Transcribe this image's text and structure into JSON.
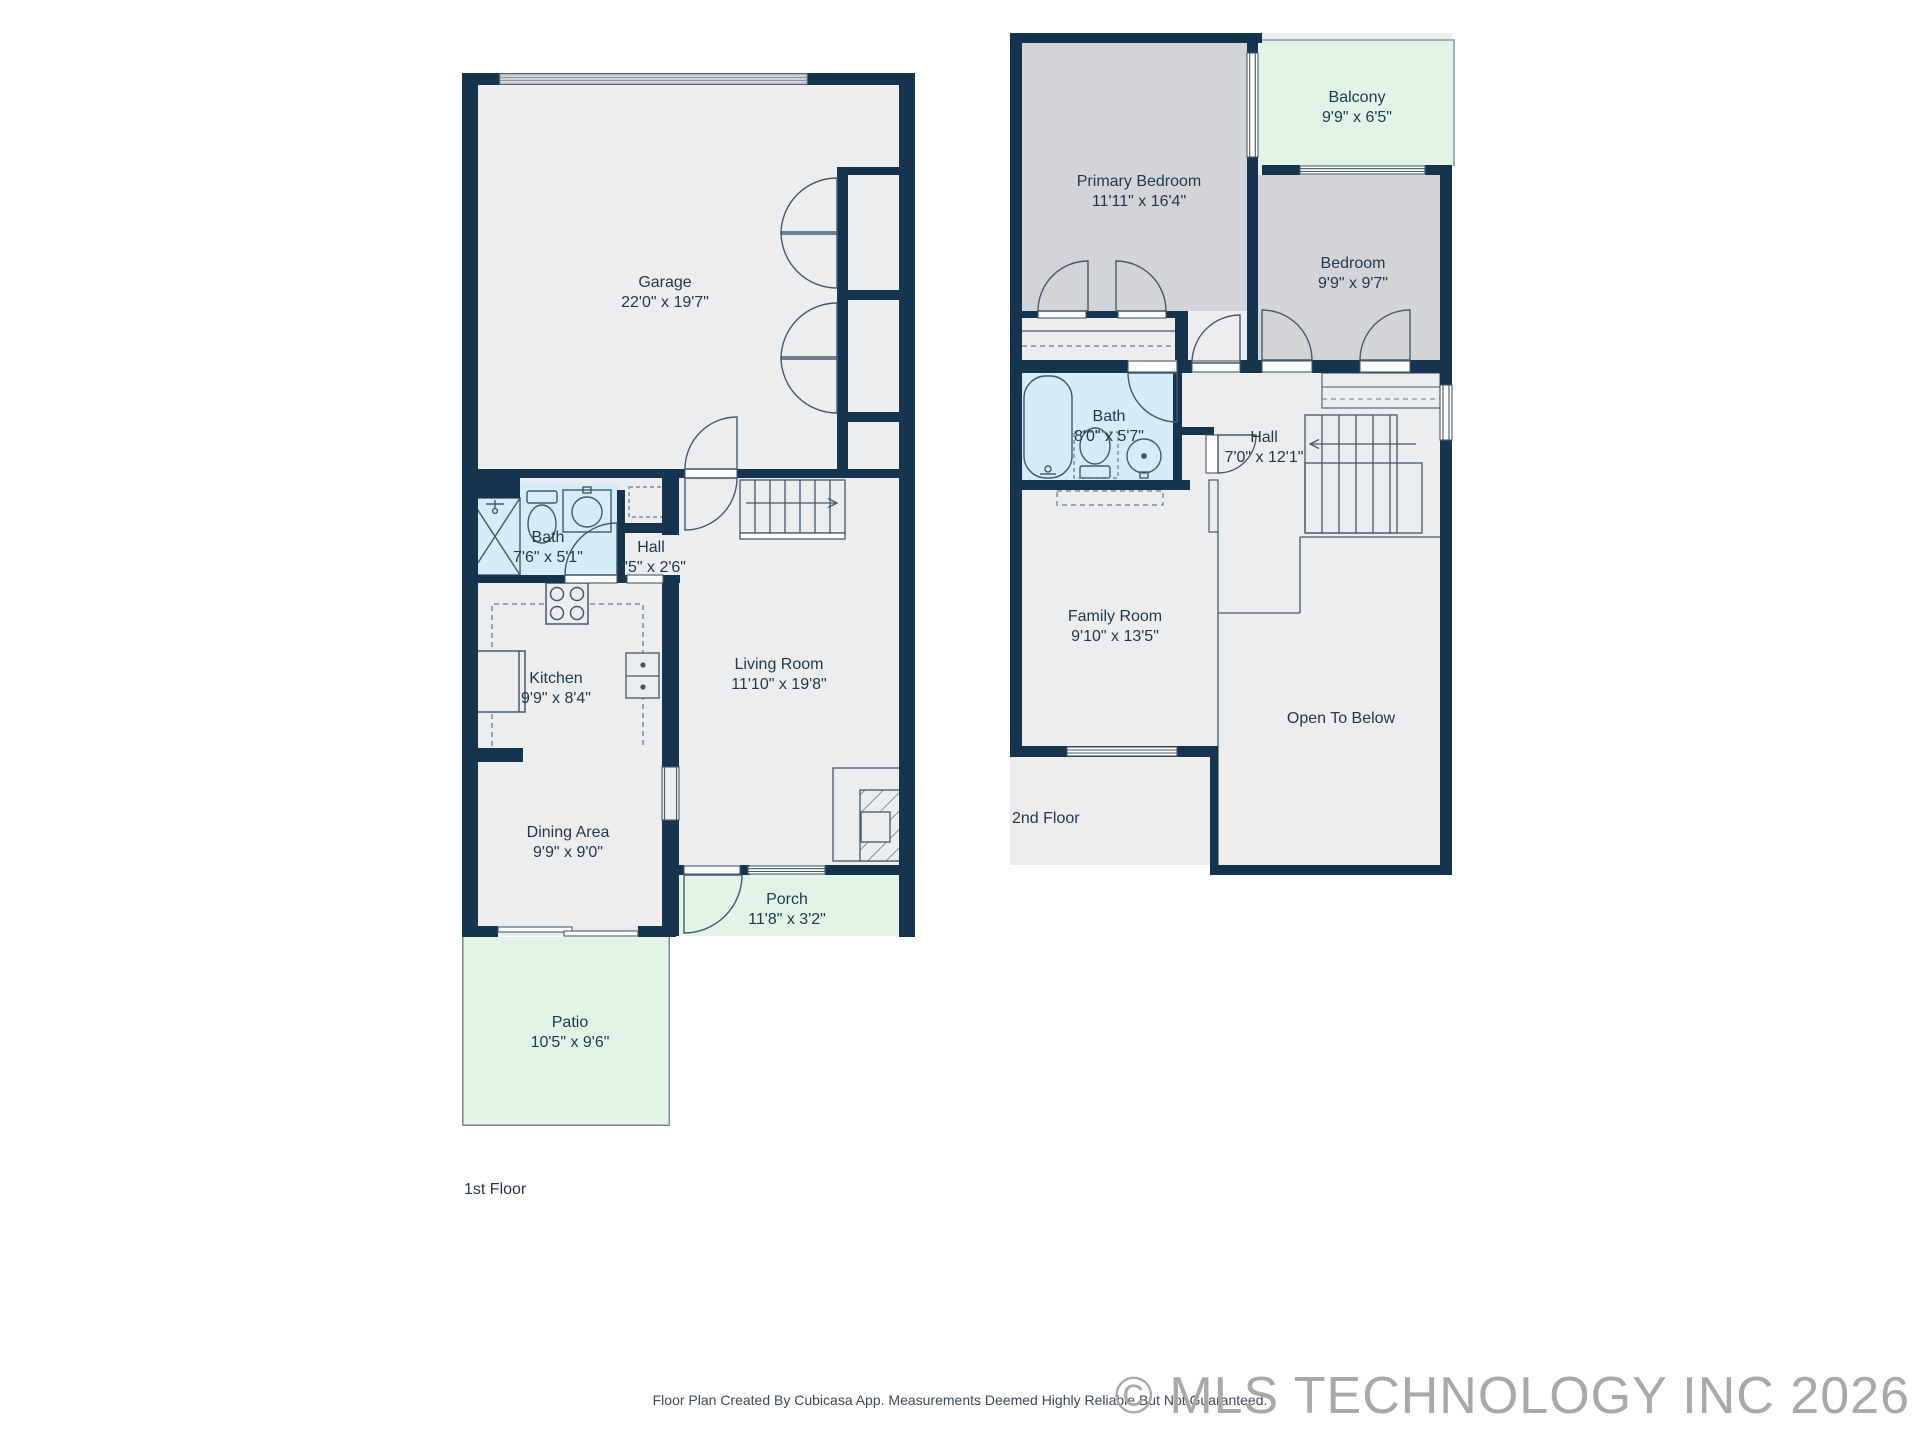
{
  "page": {
    "footer_note": "Floor Plan Created By Cubicasa App. Measurements Deemed Highly Reliable But Not Guaranteed.",
    "copyright": "© MLS TECHNOLOGY INC 2026"
  },
  "colors": {
    "wall": "#17344f",
    "floor": "#ebedee",
    "bedroom_floor": "#d2d4d7",
    "bath_floor": "#d5ecf9",
    "outdoor": "#e1f4e6",
    "garage_door": "#cdd2d6",
    "label_text": "#24384d"
  },
  "floor1": {
    "label": "1st Floor",
    "rooms": {
      "garage": {
        "name": "Garage",
        "dims": "22'0\" x 19'7\""
      },
      "bath": {
        "name": "Bath",
        "dims": "7'6\" x 5'1\""
      },
      "hall": {
        "name": "Hall",
        "dims": "2'5\" x 2'6\""
      },
      "kitchen": {
        "name": "Kitchen",
        "dims": "9'9\" x 8'4\""
      },
      "living": {
        "name": "Living Room",
        "dims": "11'10\" x 19'8\""
      },
      "dining": {
        "name": "Dining Area",
        "dims": "9'9\" x 9'0\""
      },
      "porch": {
        "name": "Porch",
        "dims": "11'8\" x 3'2\""
      },
      "patio": {
        "name": "Patio",
        "dims": "10'5\" x 9'6\""
      }
    }
  },
  "floor2": {
    "label": "2nd Floor",
    "rooms": {
      "primary": {
        "name": "Primary Bedroom",
        "dims": "11'11\" x 16'4\""
      },
      "balcony": {
        "name": "Balcony",
        "dims": "9'9\" x 6'5\""
      },
      "bedroom": {
        "name": "Bedroom",
        "dims": "9'9\" x 9'7\""
      },
      "bath": {
        "name": "Bath",
        "dims": "8'0\" x 5'7\""
      },
      "hall": {
        "name": "Hall",
        "dims": "7'0\" x 12'1\""
      },
      "family": {
        "name": "Family Room",
        "dims": "9'10\" x 13'5\""
      },
      "open": {
        "name": "Open To Below",
        "dims": ""
      }
    }
  }
}
